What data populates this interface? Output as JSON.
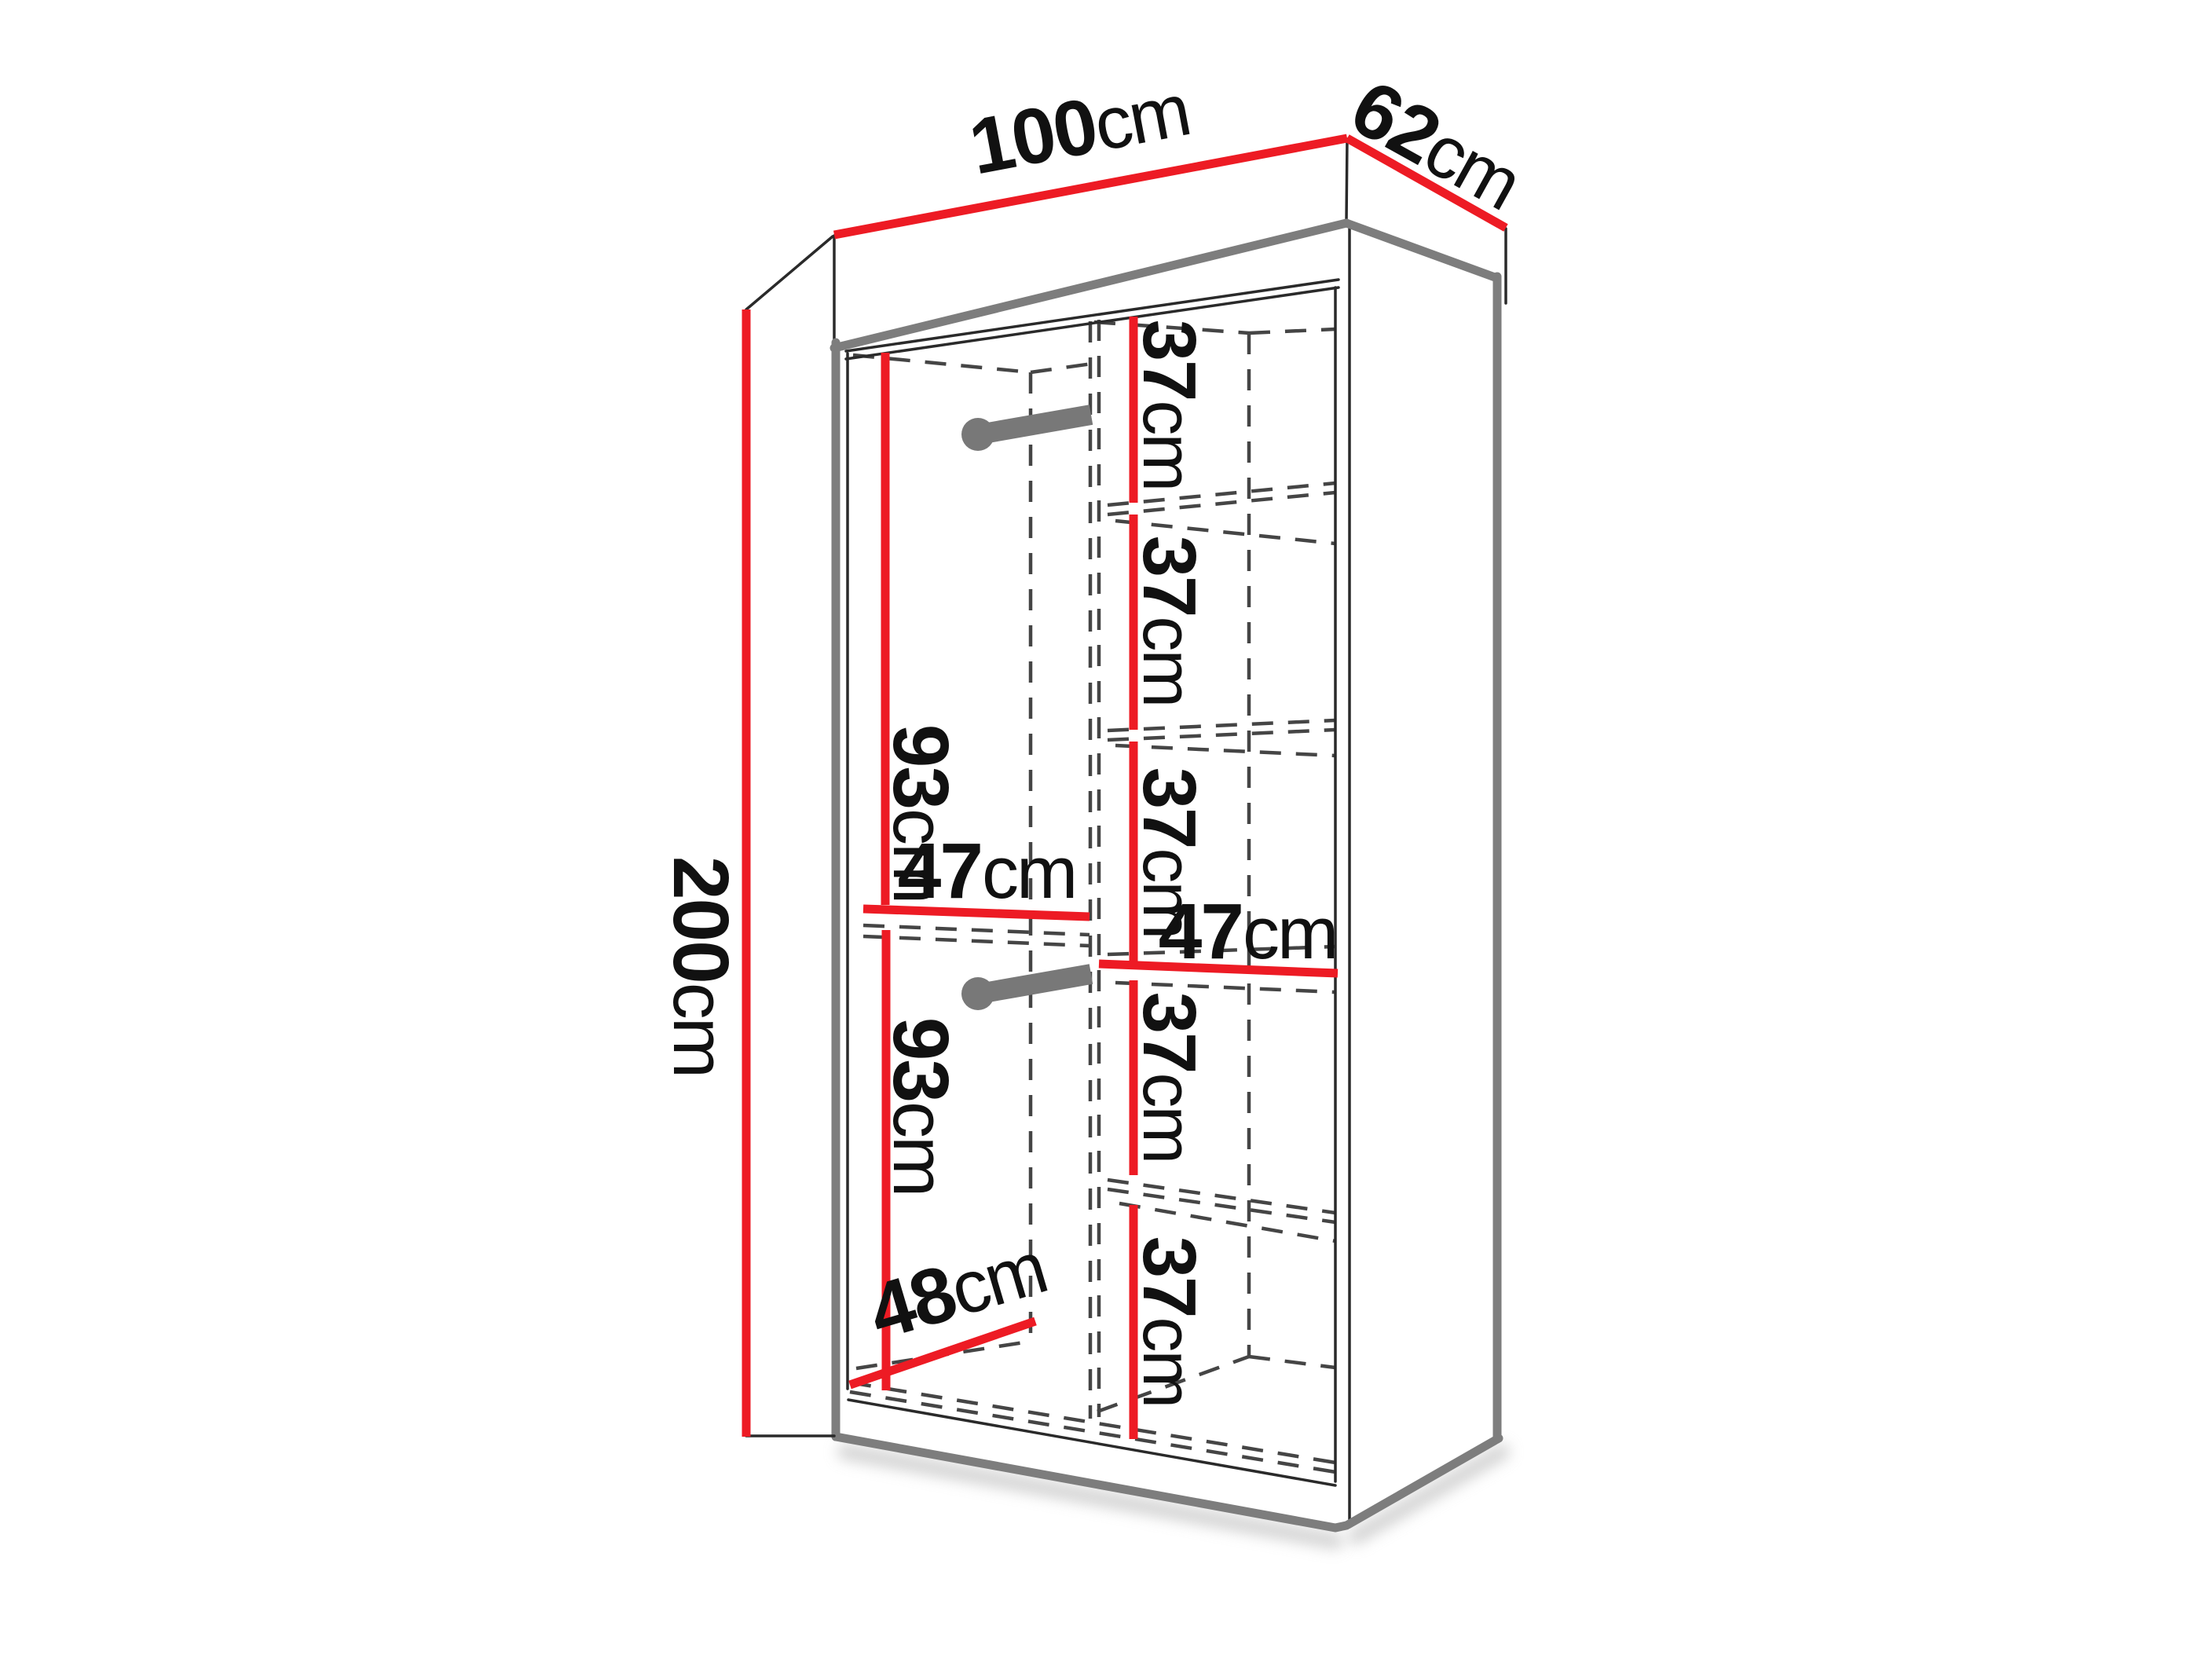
{
  "diagram": {
    "subject": "wardrobe-dimension-diagram",
    "background": "#ffffff",
    "colors": {
      "dimension_red": "#ed1b24",
      "edge_gray": "#7d7d7d",
      "dash_gray": "#454545",
      "text_black": "#111111",
      "shadow_gray": "#b5b5b5"
    },
    "dimensions": {
      "width_top": {
        "value": "100",
        "unit": "cm"
      },
      "depth_top": {
        "value": "62",
        "unit": "cm"
      },
      "height_left": {
        "value": "200",
        "unit": "cm"
      },
      "upper_section": {
        "value": "93",
        "unit": "cm"
      },
      "lower_section": {
        "value": "93",
        "unit": "cm"
      },
      "mid_width": {
        "value": "47",
        "unit": "cm"
      },
      "shelf_width": {
        "value": "47",
        "unit": "cm"
      },
      "bottom_depth": {
        "value": "48",
        "unit": "cm"
      },
      "shelf_gaps": [
        {
          "value": "37",
          "unit": "cm"
        },
        {
          "value": "37",
          "unit": "cm"
        },
        {
          "value": "37",
          "unit": "cm"
        },
        {
          "value": "37",
          "unit": "cm"
        },
        {
          "value": "37",
          "unit": "cm"
        }
      ]
    }
  }
}
